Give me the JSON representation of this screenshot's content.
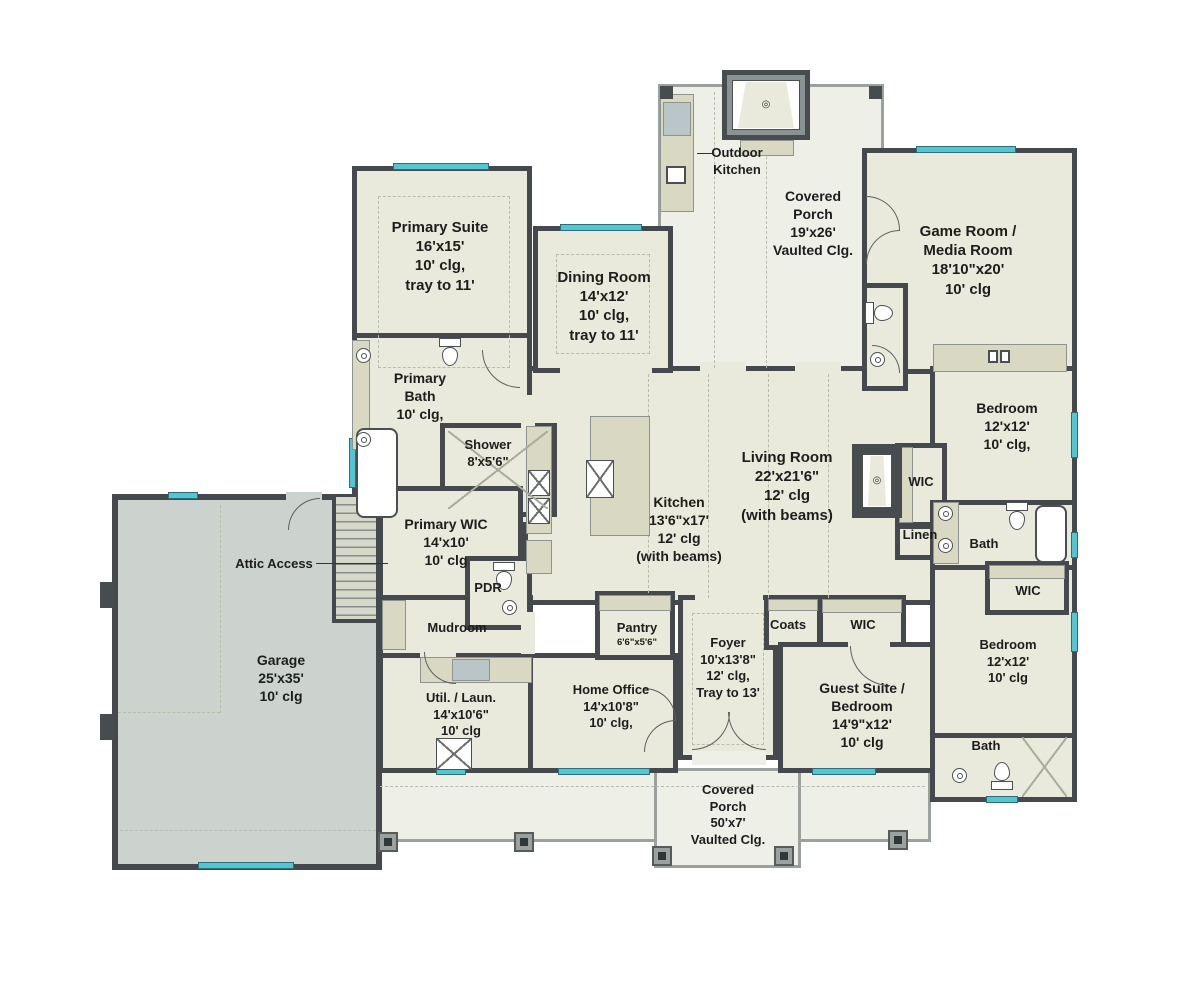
{
  "palette": {
    "wall": "#45494d",
    "floor": "#e9e9dc",
    "garage_floor": "#ccd2ce",
    "porch_floor": "#eef0e7",
    "cabinet": "#d8d8c3",
    "window": "#55c6d1",
    "text": "#1d1d1d"
  },
  "rooms": {
    "primary_suite": {
      "lines": [
        "Primary Suite",
        "16'x15'",
        "10' clg,",
        "tray to 11'"
      ]
    },
    "dining_room": {
      "lines": [
        "Dining Room",
        "14'x12'",
        "10' clg,",
        "tray to 11'"
      ]
    },
    "outdoor_kitchen": {
      "lines": [
        "Outdoor",
        "Kitchen"
      ]
    },
    "rear_porch": {
      "lines": [
        "Covered",
        "Porch",
        "19'x26'",
        "Vaulted Clg."
      ]
    },
    "game_room": {
      "lines": [
        "Game Room /",
        "Media Room",
        "18'10\"x20'",
        "10' clg"
      ]
    },
    "primary_bath": {
      "lines": [
        "Primary",
        "Bath",
        "10' clg,"
      ]
    },
    "shower": {
      "lines": [
        "Shower",
        "8'x5'6\""
      ]
    },
    "bedroom_upper": {
      "lines": [
        "Bedroom",
        "12'x12'",
        "10' clg,"
      ]
    },
    "wic_right": {
      "lines": [
        "WIC"
      ]
    },
    "linen": {
      "lines": [
        "Linen"
      ]
    },
    "bath_right": {
      "lines": [
        "Bath"
      ]
    },
    "primary_wic": {
      "lines": [
        "Primary WIC",
        "14'x10'",
        "10' clg"
      ]
    },
    "kitchen": {
      "lines": [
        "Kitchen",
        "13'6\"x17'",
        "12' clg",
        "(with beams)"
      ]
    },
    "living_room": {
      "lines": [
        "Living Room",
        "22'x21'6\"",
        "12' clg",
        "(with beams)"
      ]
    },
    "attic_access": {
      "lines": [
        "Attic Access"
      ]
    },
    "pdr": {
      "lines": [
        "PDR"
      ]
    },
    "mudroom": {
      "lines": [
        "Mudroom"
      ]
    },
    "pantry": {
      "name": "Pantry",
      "dims": "6'6\"x5'6\""
    },
    "coats": {
      "lines": [
        "Coats"
      ]
    },
    "wic_guest": {
      "lines": [
        "WIC"
      ]
    },
    "garage": {
      "lines": [
        "Garage",
        "25'x35'",
        "10' clg"
      ]
    },
    "util_laun": {
      "lines": [
        "Util. / Laun.",
        "14'x10'6\"",
        "10' clg"
      ]
    },
    "home_office": {
      "lines": [
        "Home Office",
        "14'x10'8\"",
        "10' clg,"
      ]
    },
    "foyer": {
      "lines": [
        "Foyer",
        "10'x13'8\"",
        "12' clg,",
        "Tray to 13'"
      ]
    },
    "guest_suite": {
      "lines": [
        "Guest Suite /",
        "Bedroom",
        "14'9\"x12'",
        "10' clg"
      ]
    },
    "bedroom_lower": {
      "lines": [
        "Bedroom",
        "12'x12'",
        "10' clg"
      ]
    },
    "bath_lower": {
      "lines": [
        "Bath"
      ]
    },
    "wic_lower": {
      "lines": [
        "WIC"
      ]
    },
    "front_porch": {
      "lines": [
        "Covered",
        "Porch",
        "50'x7'",
        "Vaulted Clg."
      ]
    }
  }
}
